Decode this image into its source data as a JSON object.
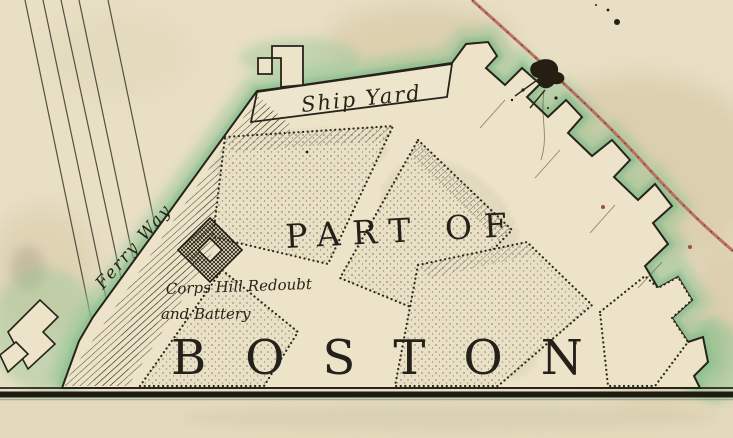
{
  "map": {
    "titles": {
      "part_of": "PART OF",
      "boston": "BOSTON"
    },
    "labels": {
      "ship_yard": "Ship Yard",
      "ferry_way": "Ferry Way",
      "corps_hill_line1": "Corps Hill Redoubt",
      "corps_hill_line2": "and Battery"
    },
    "colors": {
      "paper": "#e8dfc5",
      "paper_below_border": "#e4dabb",
      "land": "#ece3c9",
      "ink": "#2a271c",
      "water_wash_green": "#8fc492",
      "water_wash_green_dark": "#76b383",
      "boundary_line_red": "#bc6f63",
      "boundary_line_dash": "#5e3a33",
      "stain_tan": "#c7b287",
      "border_teal": "#6f9c88"
    }
  }
}
